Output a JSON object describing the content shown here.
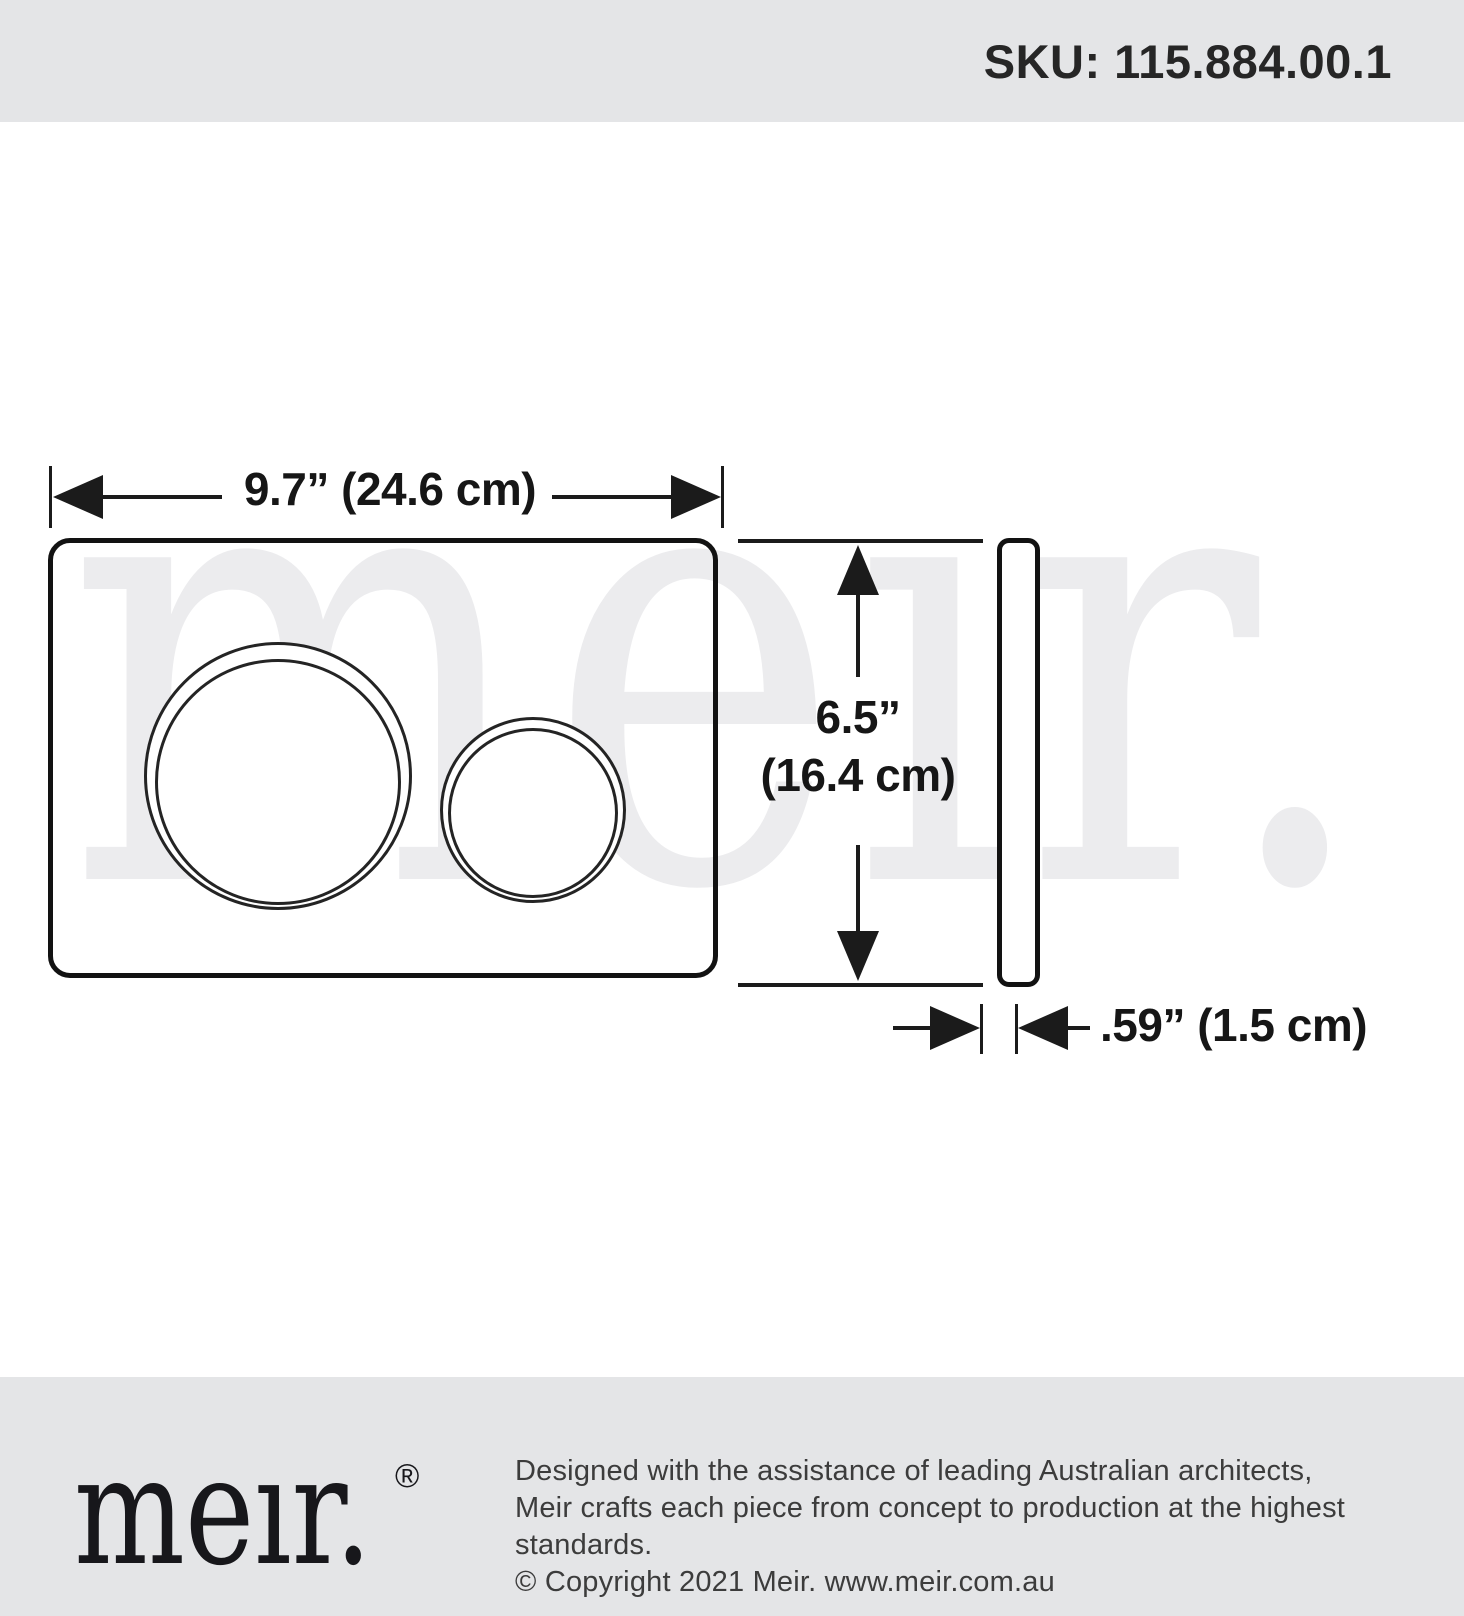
{
  "header": {
    "sku": "SKU: 115.884.00.1"
  },
  "diagram": {
    "watermark_text": "meır.",
    "width_label": "9.7” (24.6 cm)",
    "height_label_line1": "6.5”",
    "height_label_line2": "(16.4 cm)",
    "depth_label": ".59” (1.5 cm)"
  },
  "footer": {
    "logo_text": "meır.",
    "registered_mark": "®",
    "tagline_line1": "Designed with the assistance of leading Australian architects,",
    "tagline_line2": "Meir crafts each piece from concept to production at the highest standards.",
    "tagline_line3": "© Copyright 2021 Meir. www.meir.com.au"
  },
  "colors": {
    "band_bg": "#e4e5e7",
    "ink": "#1b1b1b",
    "watermark": "#ececee",
    "footer_text": "#3c3c3c"
  }
}
